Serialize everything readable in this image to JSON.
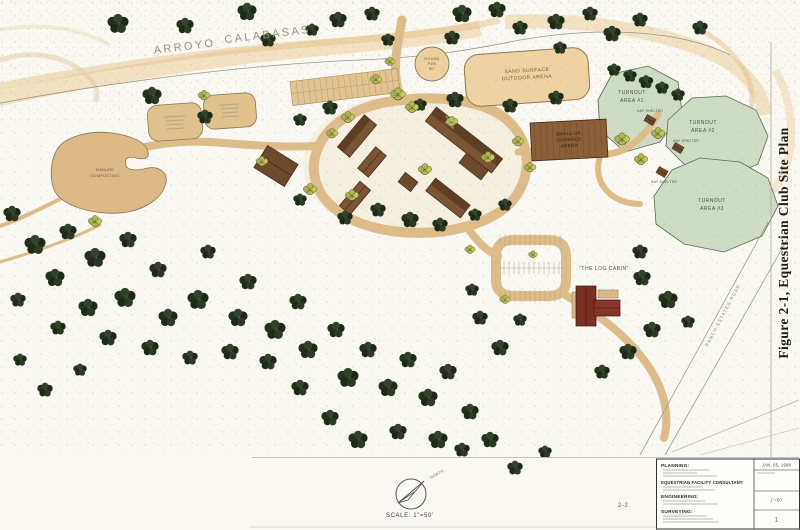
{
  "map": {
    "arroyo": {
      "word1": "ARROYO",
      "word2": "CALABASAS"
    },
    "arena": {
      "line1": "SAND SURFACE",
      "line2": "OUTDOOR ARENA"
    },
    "round_pen": {
      "line1": "ROUND",
      "line2": "PEN",
      "line3": "60'"
    },
    "covered_arena": {
      "line1": "SMALL  OR",
      "line2": "COVERED",
      "line3": "ARENA"
    },
    "main_barn": {
      "line1": "MAIN",
      "line2": "BARN"
    },
    "manure": {
      "line1": "MANURE",
      "line2": "COMPOSTING"
    },
    "turnout1": {
      "line1": "TURNOUT",
      "line2": "AREA #1",
      "shelter": "HAY SHELTER"
    },
    "turnout2": {
      "line1": "TURNOUT",
      "line2": "AREA #2",
      "shelter": "HAY SHELTER"
    },
    "turnout3": {
      "line1": "TURNOUT",
      "line2": "AREA #3",
      "shelter": "HAY SHELTER"
    },
    "log_cabin": "\"THE LOG CABIN\"",
    "road_label": "RANCH ESTATES ROAD",
    "north_label": "NORTH",
    "scale_label": "SCALE: 1\"=50'"
  },
  "figure": {
    "title": "Figure 2-1, Equestrian Club Site Plan",
    "page": "2-2"
  },
  "titleblock": {
    "planning": "PLANNING:",
    "consultant": "EQUESTRIAN FACILITY CONSULTANT:",
    "engineering": "ENGINEERING:",
    "surveying": "SURVEYING:",
    "date": "JAN. 05, 1998",
    "scale_value": "1\"=50'",
    "sheet_no": "1"
  },
  "colors": {
    "paper": "#faf8f2",
    "road_tan": "#ddbc8a",
    "arena_sand": "#eed2a2",
    "turnout_green": "#cddcc3",
    "tree_green": "#28361f",
    "shrub_green": "#b9bc53",
    "barn_brown": "#7a5433",
    "cabin_red": "#7d2f23"
  }
}
